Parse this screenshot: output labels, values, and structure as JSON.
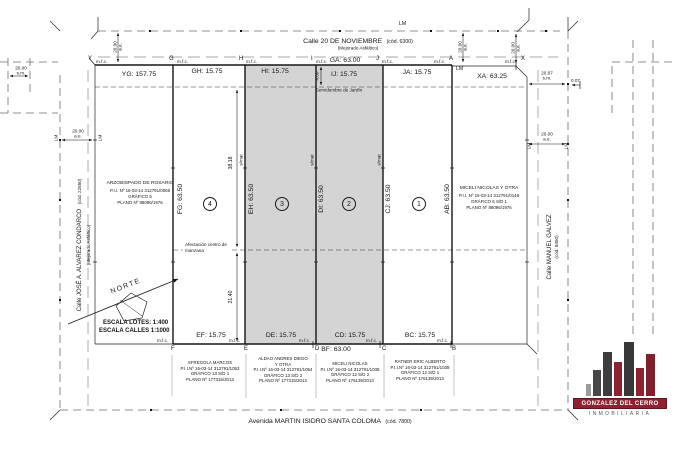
{
  "streets": {
    "top": {
      "name": "Calle 20 DE NOVIEMBRE",
      "code": "(cód. 6300)",
      "surface": "(Mejorado Asfáltico)"
    },
    "left": {
      "name": "Calle JOSÉ A. ALVAREZ CONDARCO",
      "code": "(cód. 22550)",
      "surface": "(Mejorado Asfáltico)"
    },
    "right": {
      "name": "Calle MANUEL GALVEZ",
      "code": "(cód. 8450)"
    },
    "bottom": {
      "name": "Avenida MARTIN ISIDRO SANTA COLOMA",
      "code": "(cód. 7800)"
    }
  },
  "points": {
    "y": "Y",
    "g": "G",
    "h": "H",
    "i": "I",
    "j": "J",
    "a": "A",
    "x": "X",
    "f": "F",
    "e": "E",
    "d": "D",
    "c": "C",
    "b": "B",
    "marker": "m.f.c.",
    "lm": "LM"
  },
  "dims_top": {
    "yg": "YG: 157.75",
    "gh": "GH: 15.75",
    "hi": "HI: 15.75",
    "ga": "GA: 63.00",
    "ij": "IJ: 15.75",
    "ja": "JA: 15.75",
    "xa": "XA: 63.25"
  },
  "dims_bottom": {
    "ef": "EF: 15.75",
    "de": "DE: 15.75",
    "cd": "CD: 15.75",
    "bc": "BC: 15.75",
    "bf": "BF: 63.00"
  },
  "dims_depth": {
    "fg": "FG: 63.50",
    "eh": "EH: 63.50",
    "di": "DI: 63.50",
    "cj": "CJ: 63.50",
    "ab": "AB: 63.50"
  },
  "dims_street": {
    "w20": "20.00",
    "ae": "a.e.",
    "sm": "s.m.",
    "w2087": "20.87",
    "w007": "0.07"
  },
  "dims_inner": {
    "serv": "4.00",
    "upper": "38.18",
    "lower": "21.40"
  },
  "lots": {
    "n1": "1",
    "n2": "2",
    "n3": "3",
    "n4": "4"
  },
  "notes": {
    "servidumbre": "Servidumbre de Jardín",
    "afect1": "Afectación centro de",
    "afect2": "manzana",
    "smat": "s/mat",
    "norte": "NORTE",
    "escala_lotes": "ESCALA LOTES: 1:400",
    "escala_calles": "ESCALA CALLES 1:1000"
  },
  "parcels": {
    "west": {
      "owner": "ARZOBISPADO DE ROSARIO",
      "pii": "P.I.I. Nº 16-03-14 312791/0066",
      "grafico": "GRÁFICO 5",
      "plano": "PLANO Nº 88096/1976"
    },
    "east": {
      "owner": "MICELI NICOLAS Y OTRA",
      "pii": "P.I.I. Nº 16-03-14 312791/0148",
      "grafico": "GRÁFICO 6 S/D 1",
      "plano": "PLANO Nº 88096/1976"
    },
    "s1": {
      "owner": "SFREGOLA MARCOS",
      "pii": "P.I.I.Nº 16-03-14 312791/1053",
      "grafico": "GRÁFICO 13 S/D 1",
      "plano": "PLANO Nº 177315/2013"
    },
    "s2": {
      "owner": "ALDAO ANDRES DIEGO",
      "owner2": "Y OTRA",
      "pii": "P.I.I.Nº 16-03-14 312791/1054",
      "grafico": "GRÁFICO 13 S/D 2",
      "plano": "PLANO Nº 177315/2013"
    },
    "s3": {
      "owner": "MICELI NICOLAS",
      "pii": "P.I.I.Nº 16-03-14 312791/1038",
      "grafico": "GRÁFICO 12 S/D 2",
      "plano": "PLANO Nº 176139/2013"
    },
    "s4": {
      "owner": "RATNER ERIC ALBERTO",
      "pii": "P.I.I.Nº 16-03-14 312791/1038",
      "grafico": "GRÁFICO 12 S/D 1",
      "plano": "PLANO Nº 176139/2013"
    }
  },
  "logo": {
    "name": "GONZALEZ DEL CERRO",
    "sub": "INMOBILIARIA"
  },
  "colors": {
    "lot_fill": "#d4d4d4",
    "line": "#1a1a1a",
    "logo_red": "#8e2230",
    "logo_dark": "#3d3d3d",
    "logo_gray": "#9b9b9b"
  }
}
